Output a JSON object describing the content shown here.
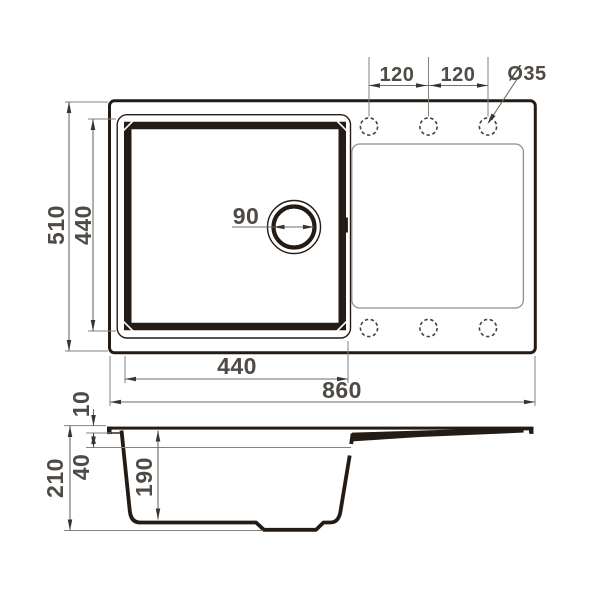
{
  "drawing_type": "sink-dimension-drawing",
  "colors": {
    "outline": "#241b14",
    "dimension_line": "#6f6b67",
    "dimension_text": "#4e4a46",
    "panel_line": "#918e8a",
    "background": "#ffffff"
  },
  "top_view": {
    "dims": {
      "overall_length": "860",
      "overall_depth": "510",
      "bowl_length": "440",
      "bowl_depth": "440",
      "hole_pitch_1": "120",
      "hole_pitch_2": "120",
      "hole_diameter": "Ø35",
      "drain_diameter": "90"
    }
  },
  "side_view": {
    "dims": {
      "overall_height": "210",
      "bowl_inner_depth": "190",
      "rim_height": "10",
      "overflow_level": "40"
    }
  }
}
